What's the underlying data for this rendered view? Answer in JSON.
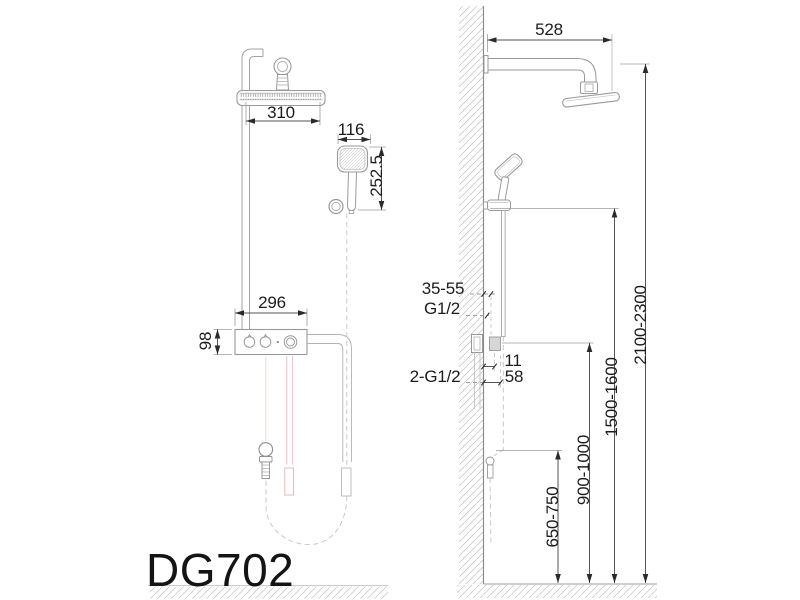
{
  "title_block": {
    "model": "DG702"
  },
  "front_view": {
    "overhead_shower_width": "310",
    "hand_shower_width": "116",
    "hand_shower_length": "252.5",
    "mixer_width": "296",
    "mixer_height": "98"
  },
  "side_view": {
    "arm_reach": "528",
    "rough_in_depth": "35-55",
    "top_thread": "G1/2",
    "bottom_threads": "2-G1/2",
    "wall_offset_small": "11",
    "wall_offset_large": "58",
    "hose_connector_height": "650-750",
    "mixer_height_range": "900-1000",
    "hand_shower_height_range": "1500-1600",
    "overhead_height_range": "2100-2300"
  },
  "colors": {
    "linework": "#9a9a9a",
    "dimension": "#555555",
    "text": "#1c1c1c",
    "hot_water_accent": "#e2b6b6",
    "hatch": "#cccccc"
  }
}
